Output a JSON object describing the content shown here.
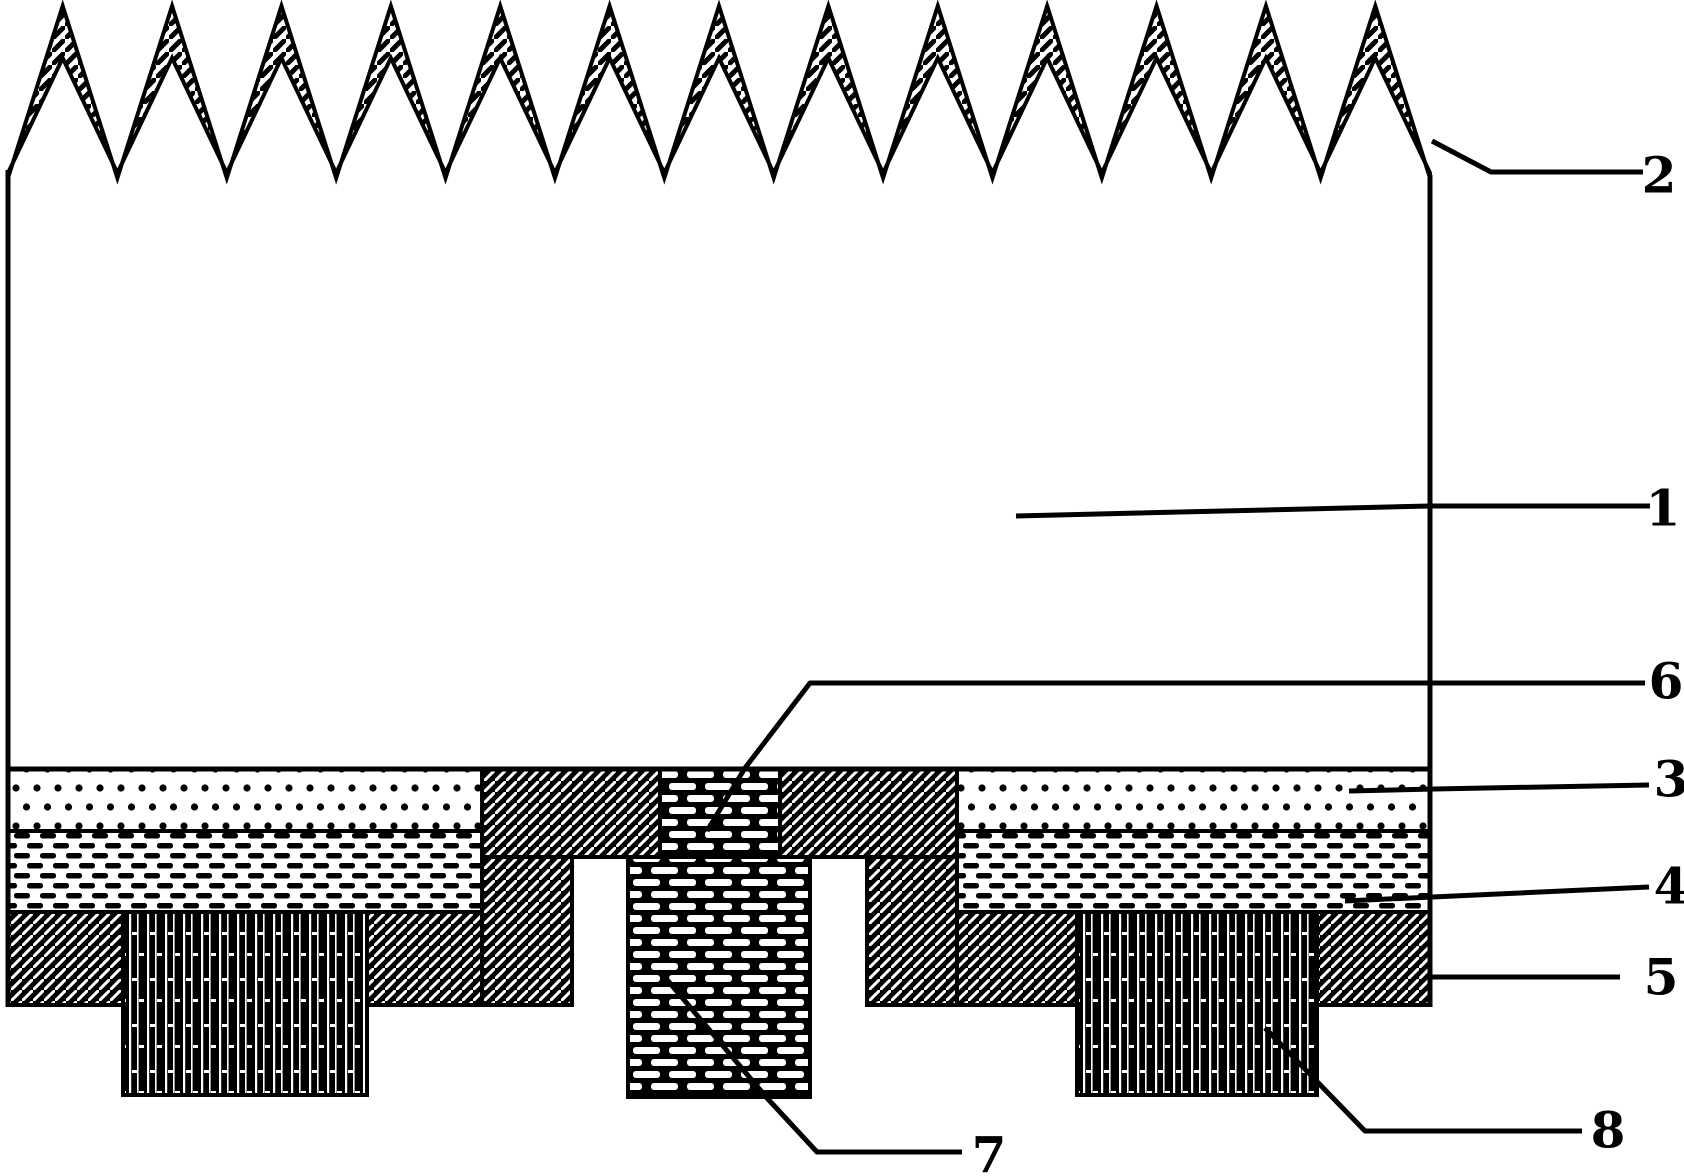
{
  "figure": {
    "description": "patent-style cross-section diagram of a textured solar cell structure",
    "canvas": {
      "width": 1684,
      "height": 1176,
      "background": "#ffffff",
      "ink": "#000000"
    },
    "zigzag_band": {
      "name": "textured-surface-layer",
      "x_start": 8,
      "x_end": 1430,
      "peak_count": 13,
      "outer_peak_y": 6,
      "outer_valley_y": 178,
      "inner_peak_y": 58,
      "inner_valley_y": 173,
      "pattern": "zigzag-hatch",
      "stroke_width": 4
    },
    "edges": [
      {
        "name": "left-substrate-edge",
        "x1": 8,
        "y1": 170,
        "x2": 8,
        "y2": 1007,
        "width": 5
      },
      {
        "name": "right-substrate-edge",
        "x1": 1430,
        "y1": 175,
        "x2": 1430,
        "y2": 1007,
        "width": 5
      },
      {
        "name": "layers-top-line",
        "x1": 8,
        "y1": 769,
        "x2": 1430,
        "y2": 769,
        "width": 5
      }
    ],
    "regions": [
      {
        "name": "dotted-layer-left",
        "pattern": "dots",
        "x": 8,
        "y": 769,
        "w": 474,
        "h": 62
      },
      {
        "name": "dotted-layer-right",
        "pattern": "dots",
        "x": 957,
        "y": 769,
        "w": 473,
        "h": 62
      },
      {
        "name": "dashed-layer-left",
        "pattern": "dashes",
        "x": 8,
        "y": 831,
        "w": 474,
        "h": 81
      },
      {
        "name": "dashed-layer-right",
        "pattern": "dashes",
        "x": 957,
        "y": 831,
        "w": 473,
        "h": 81
      },
      {
        "name": "hatch-layer-left-outer",
        "pattern": "hatch",
        "x": 8,
        "y": 912,
        "w": 115,
        "h": 93
      },
      {
        "name": "hatch-layer-left-inner",
        "pattern": "hatch",
        "x": 367,
        "y": 912,
        "w": 115,
        "h": 93
      },
      {
        "name": "hatch-contact-left-top",
        "pattern": "hatch",
        "x": 482,
        "y": 769,
        "w": 178,
        "h": 88
      },
      {
        "name": "hatch-contact-left-leg",
        "pattern": "hatch",
        "x": 482,
        "y": 857,
        "w": 90,
        "h": 148
      },
      {
        "name": "hatch-contact-right-top",
        "pattern": "hatch",
        "x": 780,
        "y": 769,
        "w": 177,
        "h": 88
      },
      {
        "name": "hatch-contact-right-leg",
        "pattern": "hatch",
        "x": 867,
        "y": 857,
        "w": 90,
        "h": 148
      },
      {
        "name": "hatch-layer-right-inner",
        "pattern": "hatch",
        "x": 957,
        "y": 912,
        "w": 120,
        "h": 93
      },
      {
        "name": "hatch-layer-right-outer",
        "pattern": "hatch",
        "x": 1317,
        "y": 912,
        "w": 113,
        "h": 93
      },
      {
        "name": "brick-via-top",
        "pattern": "bricks",
        "x": 660,
        "y": 769,
        "w": 120,
        "h": 88
      },
      {
        "name": "brick-via-column",
        "pattern": "bricks",
        "x": 628,
        "y": 857,
        "w": 182,
        "h": 240
      },
      {
        "name": "electrode-block-left",
        "pattern": "vlines",
        "x": 123,
        "y": 912,
        "w": 244,
        "h": 183
      },
      {
        "name": "electrode-block-right",
        "pattern": "vlines",
        "x": 1077,
        "y": 912,
        "w": 240,
        "h": 183
      }
    ],
    "callouts": [
      {
        "label": "1",
        "points": [
          [
            1016,
            516
          ],
          [
            1430,
            506
          ],
          [
            1650,
            506
          ]
        ],
        "label_pos": [
          1663,
          508
        ]
      },
      {
        "label": "2",
        "points": [
          [
            1432,
            141
          ],
          [
            1491,
            172
          ],
          [
            1643,
            172
          ]
        ],
        "label_pos": [
          1659,
          175
        ]
      },
      {
        "label": "3",
        "points": [
          [
            1349,
            791
          ],
          [
            1434,
            789
          ],
          [
            1649,
            785
          ]
        ],
        "label_pos": [
          1671,
          779
        ]
      },
      {
        "label": "4",
        "points": [
          [
            1345,
            901
          ],
          [
            1649,
            887
          ]
        ],
        "label_pos": [
          1671,
          886
        ]
      },
      {
        "label": "5",
        "points": [
          [
            1432,
            977
          ],
          [
            1620,
            977
          ]
        ],
        "label_pos": [
          1661,
          977
        ]
      },
      {
        "label": "6",
        "points": [
          [
            707,
            831
          ],
          [
            745,
            768
          ],
          [
            810,
            683
          ],
          [
            1645,
            683
          ]
        ],
        "label_pos": [
          1666,
          681
        ]
      },
      {
        "label": "7",
        "points": [
          [
            663,
            975
          ],
          [
            767,
            1098
          ],
          [
            817,
            1152
          ],
          [
            962,
            1152
          ]
        ],
        "label_pos": [
          989,
          1155
        ]
      },
      {
        "label": "8",
        "points": [
          [
            1265,
            1028
          ],
          [
            1365,
            1131
          ],
          [
            1582,
            1131
          ]
        ],
        "label_pos": [
          1608,
          1130
        ]
      }
    ],
    "patterns": {
      "hatch": {
        "style": "black ground, white diagonal lines",
        "bg": "#000000",
        "fg": "#ffffff"
      },
      "zigzag-hatch": {
        "style": "white ground, black diagonal lines",
        "bg": "#ffffff",
        "fg": "#000000"
      },
      "dots": {
        "style": "black polka dots on white",
        "bg": "#ffffff",
        "fg": "#000000"
      },
      "dashes": {
        "style": "black staggered dashes on white",
        "bg": "#ffffff",
        "fg": "#000000"
      },
      "bricks": {
        "style": "white brick dashes on black",
        "bg": "#000000",
        "fg": "#ffffff"
      },
      "vlines": {
        "style": "white vertical lines on black",
        "bg": "#000000",
        "fg": "#ffffff"
      }
    }
  }
}
